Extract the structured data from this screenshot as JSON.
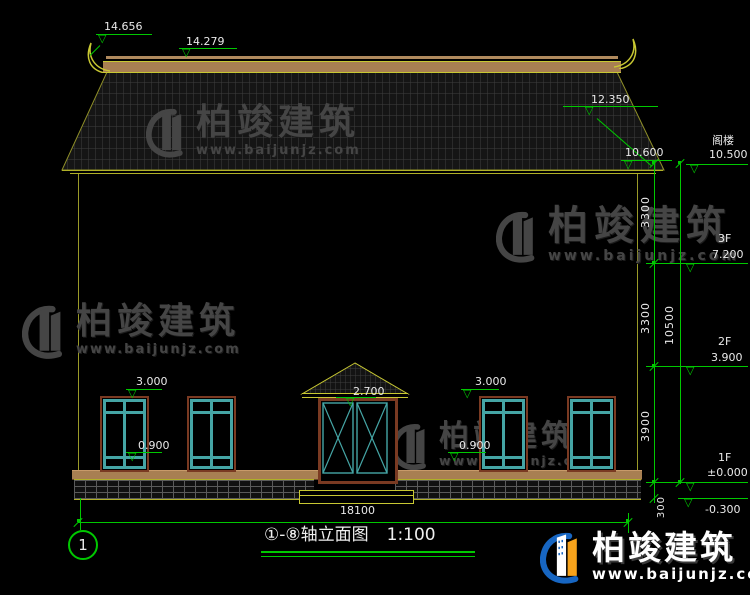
{
  "drawing": {
    "title_axes": "①-⑧轴立面图",
    "title_scale": "1:100",
    "grid_bubble_left": "1"
  },
  "markers": {
    "ridge_tip": "14.656",
    "ridge_top": "14.279",
    "roof_slope": "12.350",
    "eave": "10.600",
    "door_head": "2.700",
    "win_left_head": "3.000",
    "win_left_sill": "0.900",
    "win_right_head": "3.000",
    "win_right_sill": "0.900"
  },
  "levels": [
    {
      "label": "阁楼",
      "value": "10.500"
    },
    {
      "label": "3F",
      "value": "7.200"
    },
    {
      "label": "2F",
      "value": "3.900"
    },
    {
      "label": "1F",
      "value": "±0.000"
    },
    {
      "label": "",
      "value": "-0.300"
    }
  ],
  "dims": {
    "v1": "3300",
    "v2": "3300",
    "v3": "3900",
    "v4": "300",
    "v_total": "10500",
    "h_total": "18100"
  },
  "watermark": {
    "brand": "柏竣建筑",
    "url": "www.baijunjz.com"
  },
  "icons": {
    "level_triangle": "▽"
  },
  "colors": {
    "background": "#000000",
    "dim_green": "#00c800",
    "line_yellow": "#b0b028",
    "window_teal": "#45a5a5",
    "frame_brown": "#7a3a22",
    "ridge_tan": "#a87f52",
    "logo_blue": "#1766c2",
    "logo_orange": "#f7a31b",
    "watermark_gray": "#454545",
    "text_white": "#e9e9e9"
  }
}
